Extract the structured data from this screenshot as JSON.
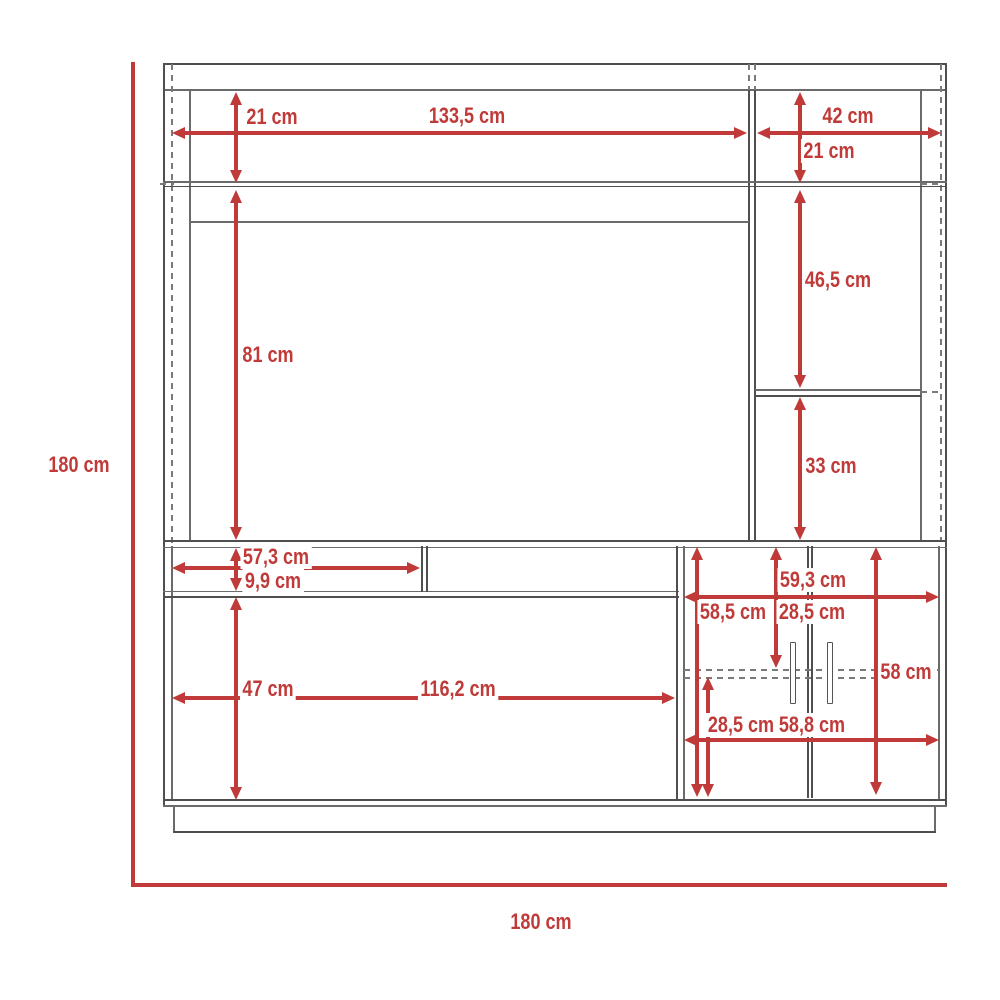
{
  "diagram": {
    "type": "furniture-dimension-drawing",
    "colors": {
      "dimension_red": "#bf3a38",
      "outline_gray": "#4f4f4f"
    },
    "measurements": {
      "overall_height": "180 cm",
      "overall_width": "180 cm",
      "upper_left": {
        "top_shelf_height": "21 cm",
        "opening_width": "133,5 cm",
        "tv_opening_height": "81 cm"
      },
      "upper_right": {
        "opening_width": "42 cm",
        "top_shelf_height": "21 cm",
        "middle_shelf_height": "46,5 cm",
        "bottom_shelf_height": "33 cm"
      },
      "lower_left": {
        "niche_width": "57,3 cm",
        "niche_height": "9,9 cm",
        "opening_height": "47 cm",
        "opening_width": "116,2 cm"
      },
      "lower_cabinet": {
        "inner_width": "59,3 cm",
        "inner_height": "58,5 cm",
        "upper_compartment_height": "28,5 cm",
        "door_height": "58 cm",
        "lower_compartment_height": "28,5 cm",
        "outer_width": "58,8 cm"
      }
    }
  }
}
